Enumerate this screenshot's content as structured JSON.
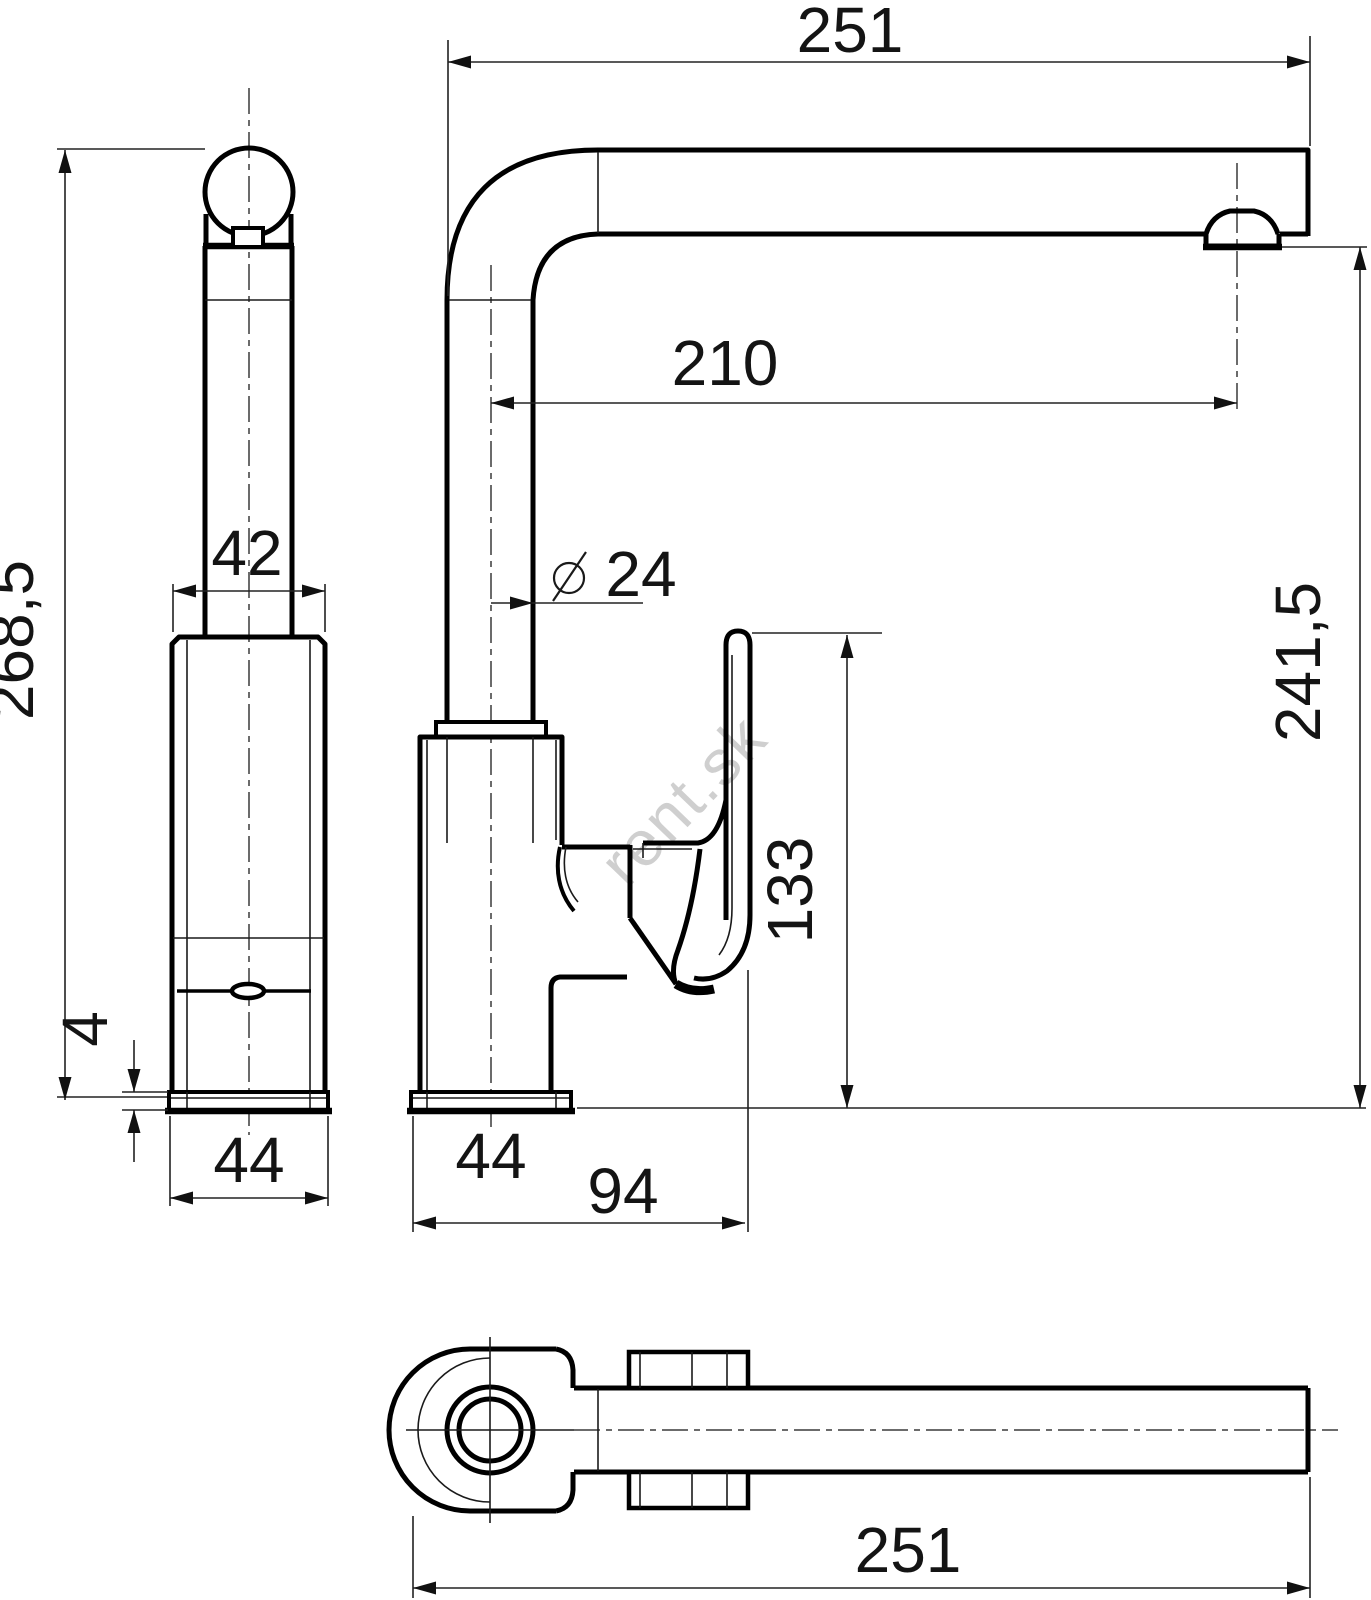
{
  "watermark": "rent.sk",
  "dimensions": {
    "spout_reach_top": "251",
    "spout_offset": "210",
    "total_height": "268,5",
    "column_width": "42",
    "pipe_diameter": "24",
    "handle_height": "133",
    "outlet_height": "241,5",
    "base_plate_thickness": "4",
    "base_width_front": "44",
    "base_width_side": "44",
    "base_depth": "94",
    "spout_reach_bottom": "251"
  }
}
